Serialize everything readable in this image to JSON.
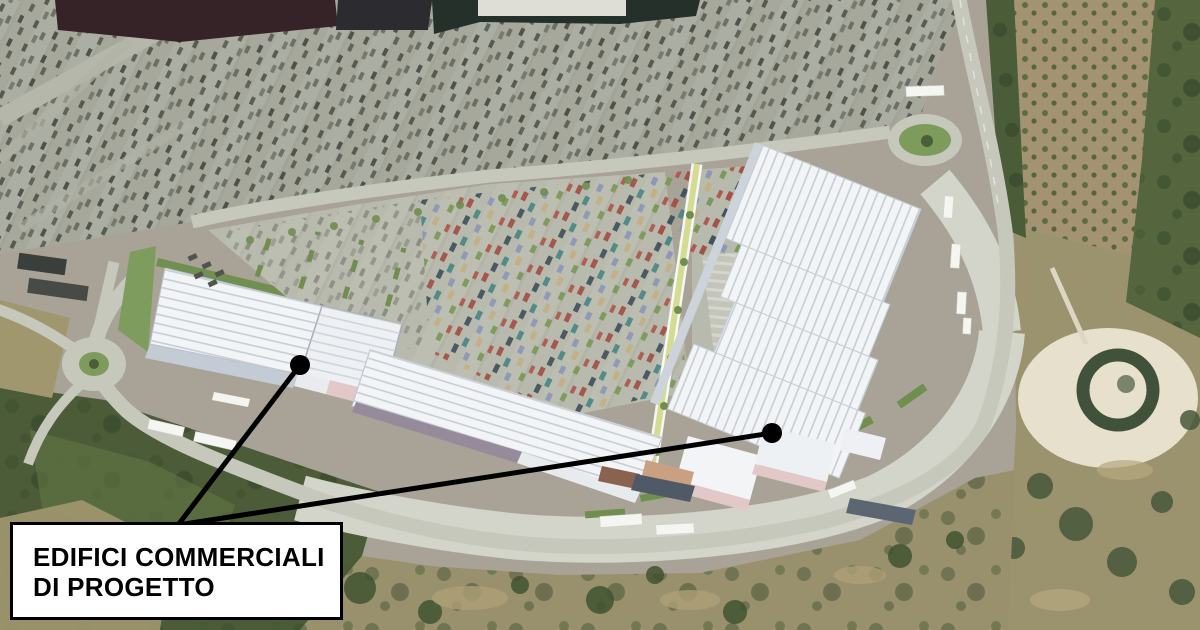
{
  "annotation": {
    "label_line1": "EDIFICI COMMERCIALI",
    "label_line2": "DI PROGETTO",
    "box": {
      "x": 10,
      "y": 522,
      "width": 333,
      "height": 98
    },
    "origin": {
      "x": 178,
      "y": 525
    },
    "leaders": [
      {
        "from_x": 178,
        "from_y": 525,
        "dot_x": 300,
        "dot_y": 365
      },
      {
        "from_x": 178,
        "from_y": 525,
        "dot_x": 772,
        "dot_y": 433
      }
    ],
    "dot_radius": 10,
    "line_width": 5
  },
  "colors": {
    "terrain_base": "#a8a396",
    "existing_parking": "#a5a89b",
    "new_parking": "#b7baac",
    "road": "#c6c8bc",
    "apron": "#d3d5cb",
    "building_white": "#f2f4f6",
    "building_rib": "#c5cdd6",
    "building_wall": "#c3cbd4",
    "facade_pink": "#e2c9c7",
    "facade_mauve": "#968b9b",
    "roof_slate": "#4f5a66",
    "roof_maroon": "#352328",
    "roof_dark_green": "#243029",
    "vegetation_dark": "#4c5c39",
    "scrub_tan": "#a1976f",
    "scrub_bottom": "#99916d",
    "scrub_right": "#9b936e",
    "orchard": "#a39372",
    "trees_edge": "#55663f",
    "tree_green": "#6f8e4f",
    "clearing": "#e6e0cd",
    "roundabout_green": "#7d9c5c",
    "walkway": "#d3dc90",
    "annotation_color": "#000000",
    "label_bg": "#ffffff"
  }
}
